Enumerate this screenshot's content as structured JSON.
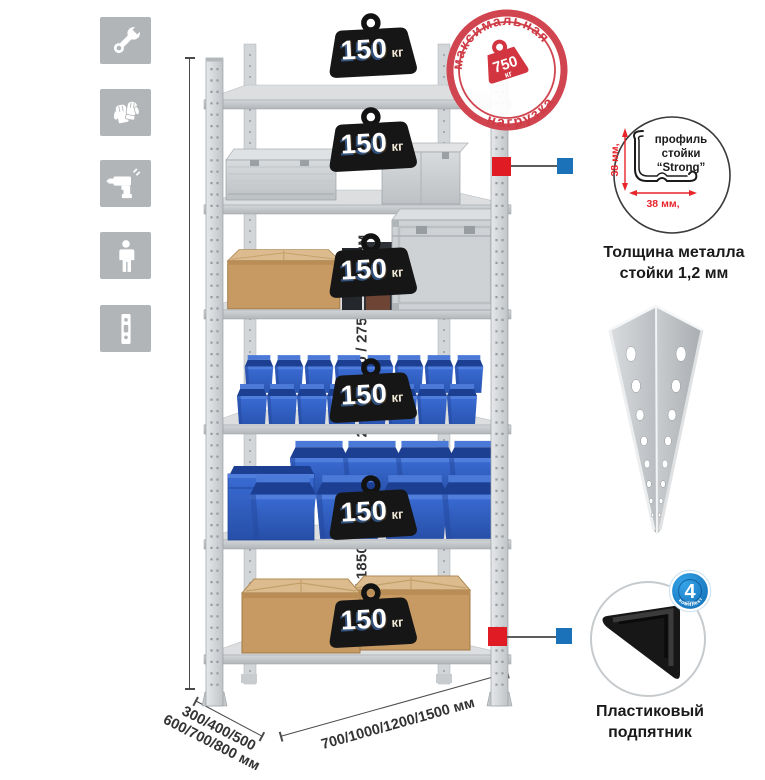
{
  "assembly_icons": {
    "items": [
      {
        "name": "wrench"
      },
      {
        "name": "gloves"
      },
      {
        "name": "drill"
      },
      {
        "name": "person"
      },
      {
        "name": "post-profile"
      }
    ]
  },
  "rack": {
    "shelf_count": 6,
    "shelf_load_badges": [
      {
        "value": "150",
        "unit": "кг"
      },
      {
        "value": "150",
        "unit": "кг"
      },
      {
        "value": "150",
        "unit": "кг"
      },
      {
        "value": "150",
        "unit": "кг"
      },
      {
        "value": "150",
        "unit": "кг"
      },
      {
        "value": "150",
        "unit": "кг"
      }
    ]
  },
  "max_load_stamp": {
    "arc_top": "максимальная",
    "arc_bottom": "нагрузка",
    "value": "750",
    "unit": "кг"
  },
  "dimensions": {
    "height_label": "1600 / 1850 / 2000 / 2200 / 2350 / 2550 / 2750 / 3100 мм",
    "depth_label_line1": "300/400/500",
    "depth_label_line2": "600/700/800 мм",
    "width_label": "700/1000/1200/1500 мм"
  },
  "profile_detail": {
    "dim_vertical": "38 мм,",
    "dim_horizontal": "38 мм,",
    "label_line1": "профиль",
    "label_line2": "стойки",
    "label_line3": "“Strong”",
    "caption_line1": "Толщина металла",
    "caption_line2": "стойки 1,2 мм"
  },
  "foot_detail": {
    "badge_value": "4",
    "badge_small_text": "штуки",
    "badge_arc_text": "в комплекте",
    "caption_line1": "Пластиковый",
    "caption_line2": "подпятник"
  },
  "colors": {
    "stamp_red": "#d0454f",
    "marker_red": "#e01b24",
    "marker_blue": "#1b72b8",
    "badge_black": "#161616",
    "bin_blue": "#2e63c6",
    "kit_badge_blue": "#1887cf"
  }
}
